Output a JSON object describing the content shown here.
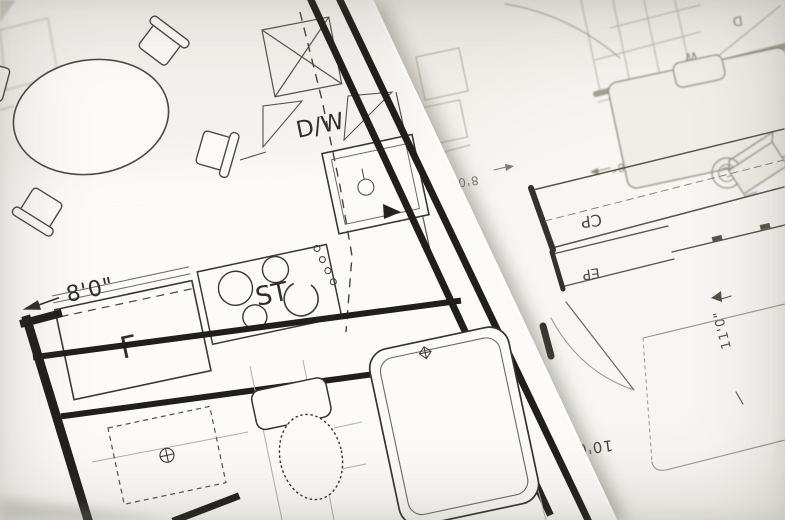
{
  "front_plan": {
    "labels": {
      "dishwasher": "D/W",
      "stove": "ST",
      "refrigerator": "F"
    },
    "dimensions": {
      "counter_run": "8'0\""
    }
  },
  "back_plan": {
    "labels": {
      "closet_cp": "CP",
      "closet_ep": "EP",
      "washer": "W",
      "dryer": "D"
    },
    "dimensions": {
      "bedroom_width": "11'0\"",
      "bedroom_length": "10'0\"",
      "closet_run": "8'0\"",
      "upper_dim": "7'8\"",
      "side_dim": "4'8\""
    }
  },
  "colors": {
    "ink_front": "#2f2e2a",
    "ink_back": "#6b685f",
    "wall": "#201f1c",
    "paper_front": "#fcfbf8",
    "paper_back": "#efede7"
  }
}
